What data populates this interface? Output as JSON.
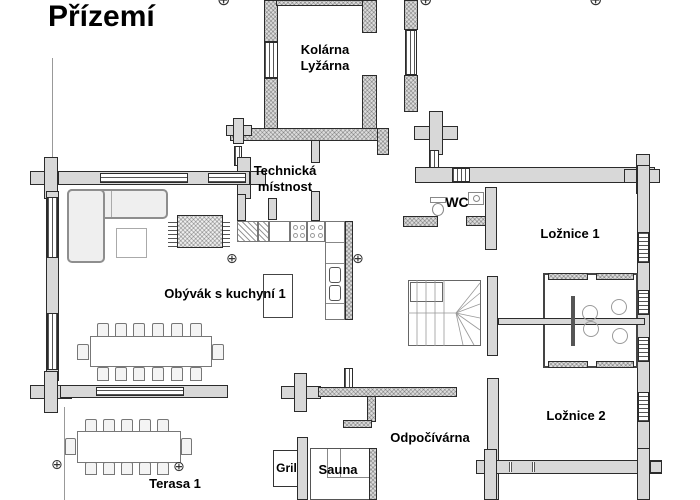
{
  "title": "Přízemí",
  "rooms": {
    "kolarna": "Kolárna Lyžárna",
    "technicka": "Technická místnost",
    "wc": "WC",
    "loznice1": "Ložnice 1",
    "obyvak": "Obývák s kuchyní 1",
    "odpocivarna": "Odpočívárna",
    "loznice2": "Ložnice 2",
    "gril": "Gril",
    "sauna": "Sauna",
    "terasa": "Terasa 1"
  },
  "symbols": {
    "survey_marker": "⊕"
  },
  "colors": {
    "wall_fill": "#d8d8d8",
    "wall_line": "#2b2b2b",
    "furniture_line": "#8e8e8e",
    "background": "#ffffff"
  }
}
